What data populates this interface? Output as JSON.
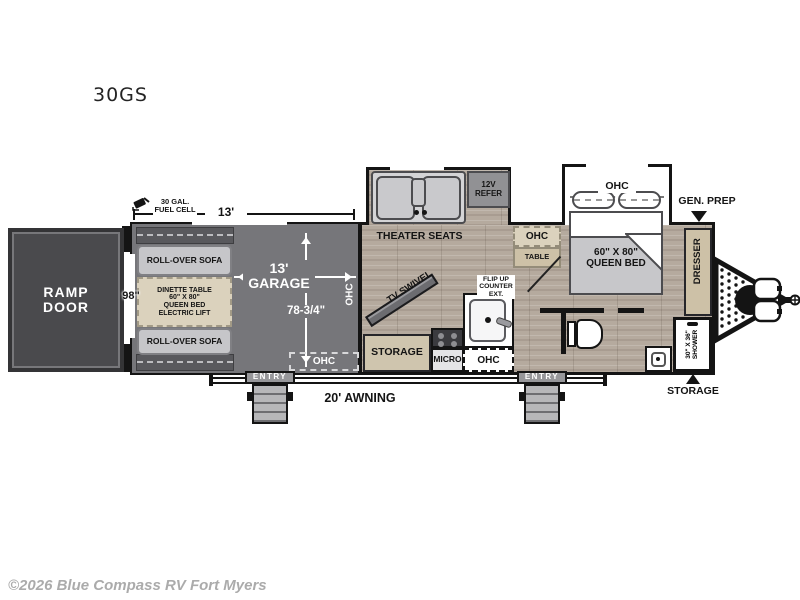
{
  "title": "30GS",
  "watermark": "©2026 Blue Compass RV Fort Myers",
  "colors": {
    "garage_floor": "#76767a",
    "wood_floor": "#b5aa9e",
    "cabinet_tan": "#dbd2bd",
    "ramp_door_gray": "#4a4a4d",
    "wall_black": "#141414",
    "watermark_gray": "#ababab"
  },
  "dimensions": {
    "rear_width": "98\"",
    "garage_length_ext": "13'",
    "fuel_cell": "30 GAL.\nFUEL CELL",
    "awning": "20' AWNING"
  },
  "garage": {
    "ramp_door": "RAMP\nDOOR",
    "sofa_top": "ROLL-OVER SOFA",
    "sofa_bottom": "ROLL-OVER SOFA",
    "dinette": "DINETTE TABLE\n60\" X 80\"\nQUEEN BED\nELECTRIC LIFT",
    "name": "13'\nGARAGE",
    "width": "78-3/4\"",
    "ohc_side": "OHC",
    "ohc_rear": "OHC",
    "entry": "ENTRY"
  },
  "living": {
    "theater_seats": "THEATER SEATS",
    "refer": "12V\nREFER",
    "tv": "TV SWIVEL",
    "storage": "STORAGE",
    "micro": "MICRO",
    "flip_counter": "FLIP UP\nCOUNTER\nEXT.",
    "ohc_kitchen": "OHC",
    "ohc_dinette": "OHC",
    "table": "TABLE",
    "entry": "ENTRY"
  },
  "bedroom": {
    "ohc": "OHC",
    "bed": "60\" X 80\"\nQUEEN BED",
    "gen_prep": "GEN. PREP",
    "dresser": "DRESSER"
  },
  "bath": {
    "shower": "30\" X 36\"\nSHOWER"
  },
  "front": {
    "storage": "STORAGE"
  }
}
